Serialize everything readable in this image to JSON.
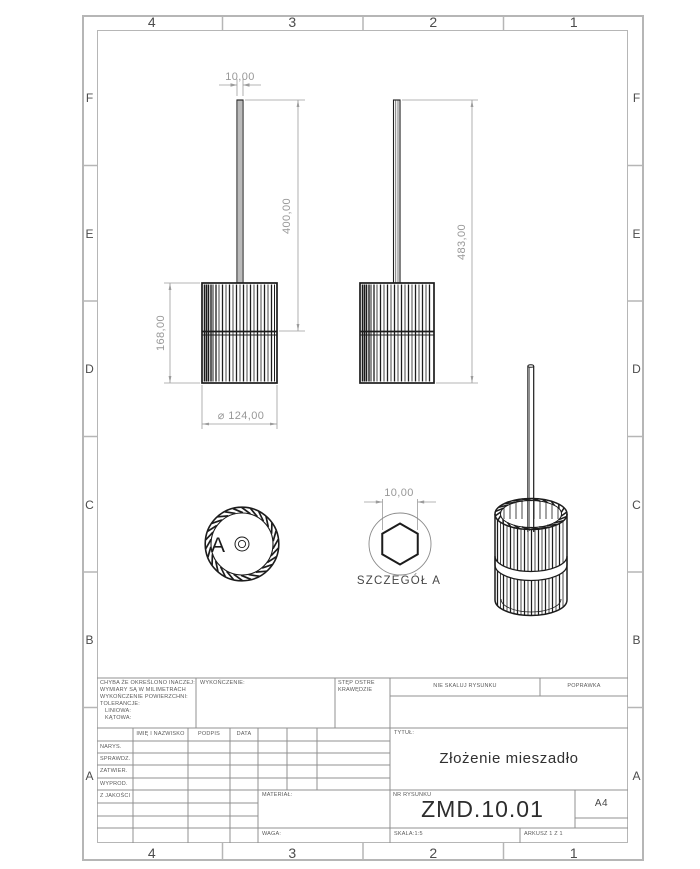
{
  "zones": {
    "columns": [
      "4",
      "3",
      "2",
      "1"
    ],
    "rows": [
      "F",
      "E",
      "D",
      "C",
      "B",
      "A"
    ]
  },
  "views": {
    "front": {
      "dim_shaft_diameter": "10,00",
      "dim_shaft_length": "400,00",
      "dim_drum_height": "168,00",
      "dim_drum_diameter": "⌀ 124,00"
    },
    "side": {
      "dim_overall_height": "483,00"
    },
    "top": {
      "detail_marker": "A"
    },
    "detail": {
      "dim_hex_across_flats": "10,00",
      "caption": "SZCZEGÓŁ A"
    }
  },
  "title_block": {
    "tolerance_lines": [
      "CHYBA ŻE OKREŚLONO INACZEJ:",
      "WYMIARY SĄ W MILIMETRACH",
      "WYKOŃCZENIE POWIERZCHNI:",
      "TOLERANCJE:",
      "LINIOWA:",
      "KĄTOWA:"
    ],
    "finish_label": "WYKOŃCZENIE:",
    "edge_note_lines": [
      "STĘP OSTRE",
      "KRAWĘDZIE"
    ],
    "do_not_scale": "NIE SKALUJ RYSUNKU",
    "revision_label": "POPRAWKA",
    "columns": {
      "name": "IMIĘ I NAZWISKO",
      "signature": "PODPIS",
      "date": "DATA"
    },
    "rows": [
      "NARYS.",
      "SPRAWDZ.",
      "ZATWIER.",
      "WYPROD.",
      "Z JAKOŚCI"
    ],
    "title_label": "TYTUŁ:",
    "title": "Złożenie mieszadło",
    "material_label": "MATERIAŁ:",
    "drawing_number_label": "NR RYSUNKU",
    "drawing_number": "ZMD.10.01",
    "paper_size": "A4",
    "weight_label": "WAGA:",
    "scale_label": "SKALA:1:5",
    "sheet_label": "ARKUSZ 1 Z 1"
  },
  "colors": {
    "line_dark": "#1c1c1c",
    "dimension_gray": "#9c9c9c",
    "frame_gray": "#b6b6b6"
  }
}
